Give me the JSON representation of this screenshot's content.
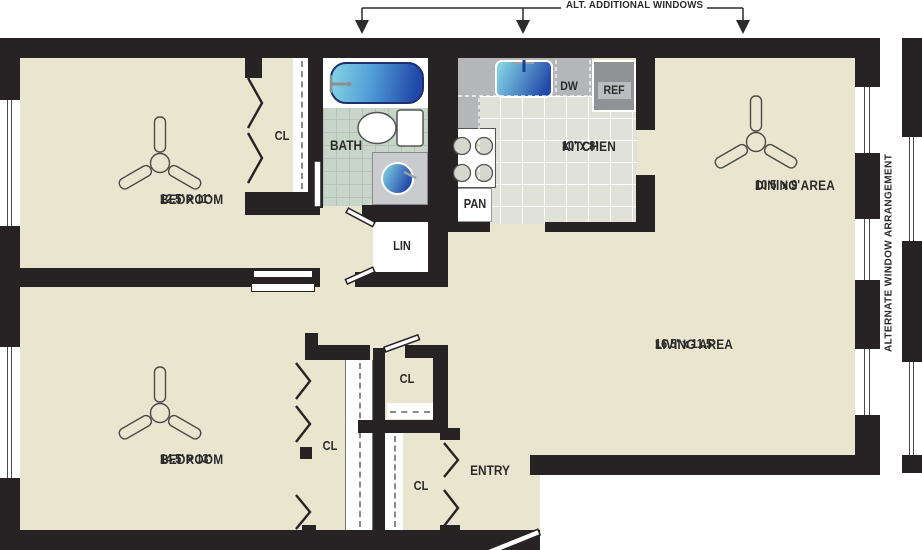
{
  "annotations": {
    "alt_windows": "ALT. ADDITIONAL WINDOWS",
    "alt_arrangement": "ALTERNATE WINDOW ARRANGEMENT"
  },
  "rooms": {
    "bedroom1": {
      "name": "BEDROOM",
      "dims": "12.5' x 11'"
    },
    "bath": {
      "name": "BATH"
    },
    "kitchen": {
      "name": "KITCHEN",
      "dims": "10' x 8'"
    },
    "dining": {
      "name": "DINING AREA",
      "dims": "10.5' x 9'"
    },
    "living": {
      "name": "LIVING AREA",
      "dims": "16.5' x 11.5'"
    },
    "bedroom2": {
      "name": "BEDROOM",
      "dims": "14.5' x 13'"
    },
    "entry": {
      "name": "ENTRY"
    }
  },
  "labels": {
    "pantry": "PAN",
    "linen": "LIN",
    "dishwasher": "DW",
    "refrigerator": "REF",
    "closet_bedroom1": "CL",
    "closet_hall": "CL",
    "closet_bedroom2": "CL",
    "closet_entry": "CL"
  },
  "colors": {
    "wall": "#272324",
    "floor": "#EAE5CF",
    "tile": "#C7D6C9",
    "kfloor": "#E0E1D9",
    "counter": "#B5B6B8",
    "appliance": "#909295",
    "blue_a": "#7FCFE3",
    "blue_b": "#2147A8"
  }
}
